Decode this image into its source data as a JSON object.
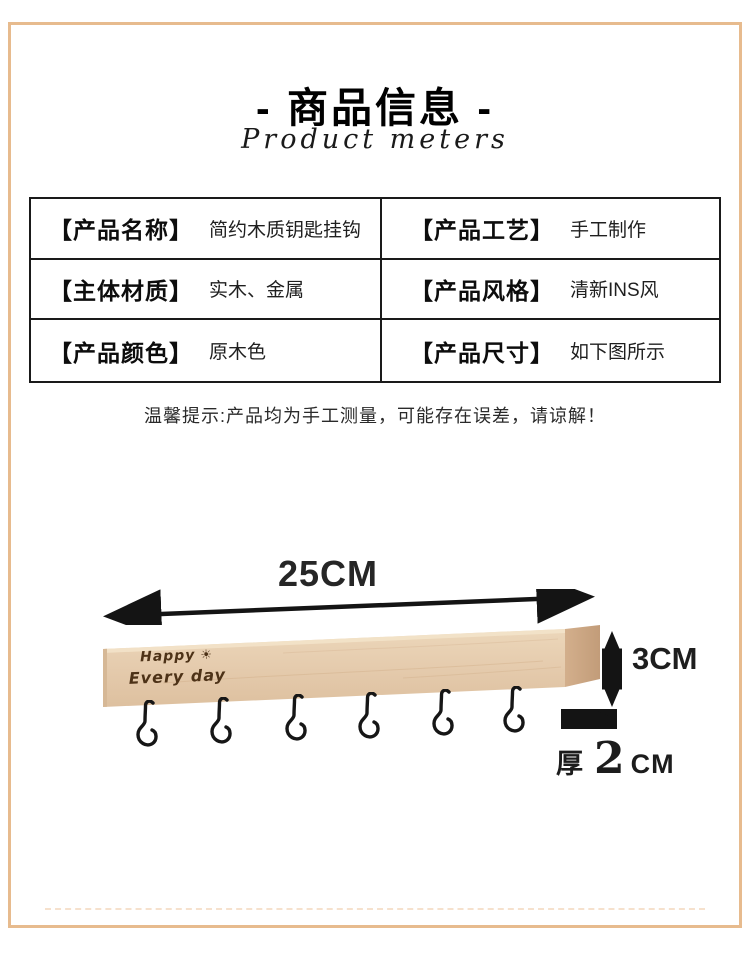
{
  "page": {
    "frame_color": "#e7bb8e",
    "background": "#ffffff"
  },
  "header": {
    "title": "- 商品信息 -",
    "subtitle": "Product meters"
  },
  "table": {
    "rows": [
      {
        "cells": [
          {
            "label": "【产品名称】",
            "value": "简约木质钥匙挂钩"
          },
          {
            "label": "【产品工艺】",
            "value": "手工制作"
          }
        ]
      },
      {
        "cells": [
          {
            "label": "【主体材质】",
            "value": "实木、金属"
          },
          {
            "label": "【产品风格】",
            "value": "清新INS风"
          }
        ]
      },
      {
        "cells": [
          {
            "label": "【产品颜色】",
            "value": "原木色"
          },
          {
            "label": "【产品尺寸】",
            "value": "如下图所示"
          }
        ]
      }
    ]
  },
  "note": "温馨提示:产品均为手工测量，可能存在误差，请谅解！",
  "figure": {
    "width_label": "25CM",
    "height_label": "3CM",
    "thickness": {
      "prefix": "厚",
      "value": "2",
      "unit": "CM"
    },
    "board_engraving": {
      "line1": "Happy",
      "sun_icon": "☀",
      "line2": "Every day"
    },
    "hook_count": 6,
    "colors": {
      "wood_front": "#e6ccaf",
      "wood_front_light": "#eedbc1",
      "wood_end": "#c9a482",
      "metal": "#161616",
      "arrow": "#141414"
    }
  }
}
